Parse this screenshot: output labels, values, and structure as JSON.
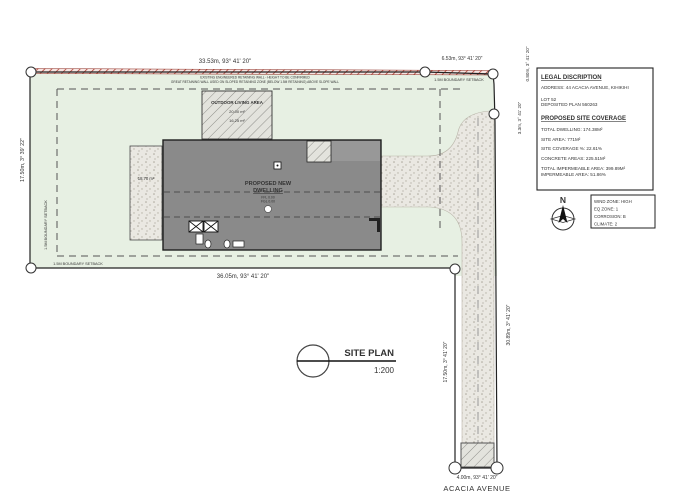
{
  "drawing": {
    "title": "SITE PLAN",
    "scale": "1:200",
    "street_name": "ACACIA AVENUE"
  },
  "legal_description": {
    "heading": "LEGAL DISCRIPTION",
    "address": "ADDRESS: 44 ACACIA AVENUE, KIHIKIHI",
    "lot": "LOT 52",
    "deposited_plan": "DEPOSITED PLAN 560263",
    "coverage_heading": "PROPOSED SITE COVERAGE",
    "total_dwelling": "TOTAL DWELLING: 174.38M²",
    "site_area": "SITE AREA: 771M²",
    "site_coverage_pct": "SITE COVERAGE %: 22.61%",
    "concrete_areas": "CONCRETE AREAS: 225.51M²",
    "total_impermeable": "TOTAL IMPERMEABLE AREA: 399.89M²",
    "impermeable_pct": "IMPERMEABLE AREA: 51.86%"
  },
  "site_classification": {
    "north": "N",
    "wind_zone": "WIND ZONE: HIGH",
    "eq_zone": "EQ ZONE: 1",
    "corrosion": "CORROSION: B",
    "climate": "CLIMATE: 2"
  },
  "boundary_dimensions": {
    "top": "33.53m, 93° 41' 20\"",
    "top_right": "6.53m, 93° 41' 20\"",
    "right_upper_short": "0.80m, 3° 41' 20\"",
    "right_upper": "3.3m, 3° 41' 20\"",
    "left": "17.50m, 3° 39' 22\"",
    "bottom_main": "36.05m, 93° 41' 20\"",
    "access_left": "17.50m, 3° 41' 20\"",
    "access_right": "30.89m, 3° 41' 20\"",
    "access_bottom": "4.00m, 93° 41' 20\""
  },
  "setback_labels": {
    "top": "1.5M BOUNDARY SETBACK",
    "left": "1.5M BOUNDARY SETBACK",
    "bottom": "1.5M BOUNDARY SETBACK"
  },
  "building": {
    "name_line1": "PROPOSED NEW",
    "name_line2": "DWELLING",
    "ffl": "FFL 0.00",
    "fgl": "FGL 0.00",
    "side_path_area": "18.70 m²"
  },
  "outdoor_living": {
    "label": "OUTDOOR LIVING AREA",
    "area_gross": "20.00 m²",
    "area_net": "16.25 m²"
  },
  "notes": {
    "retaining_wall_1": "EXISTING ENGINEERED RETAINING WALL - HEIGHT TO BE CONFIRMED",
    "retaining_wall_2": "GREAT RETAINING WALL USED ON SLOPED RETAINING ZONE (BELOW 1.5M RETAINING) ABOVE SLOPE WALL"
  },
  "colors": {
    "boundary_red": "#b03a2e",
    "site_green": "#e7f0e3",
    "building_grey": "#8a8a8a",
    "concrete": "#eae8e2"
  }
}
